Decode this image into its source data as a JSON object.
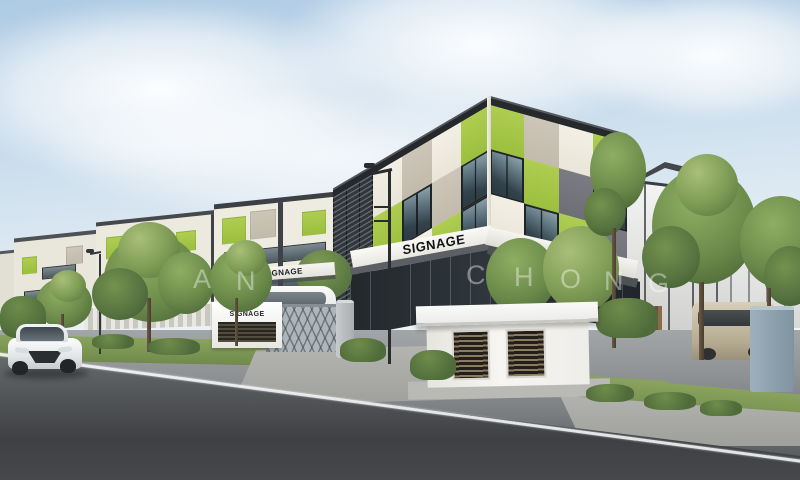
{
  "signage": {
    "main_canopy": "SIGNAGE",
    "left_canopy": "SIGNAGE",
    "gate_wall": "SIGNAGE"
  },
  "watermark": {
    "letters": [
      "A",
      "N",
      "C",
      "H",
      "O",
      "N",
      "G"
    ]
  },
  "palette": {
    "facade_green": "#a3c648",
    "facade_taupe": "#c9c2b4",
    "facade_cream": "#f0ece1",
    "facade_dark_gray": "#75757d",
    "window_glass": "#33434c",
    "roof_fascia": "#26292c",
    "sky_top": "#aecbe4",
    "asphalt_dark": "#3e4044",
    "concrete_light": "#b4b5b1",
    "grass_green": "#7d9a57",
    "tree_green": "#6a8a4a"
  }
}
